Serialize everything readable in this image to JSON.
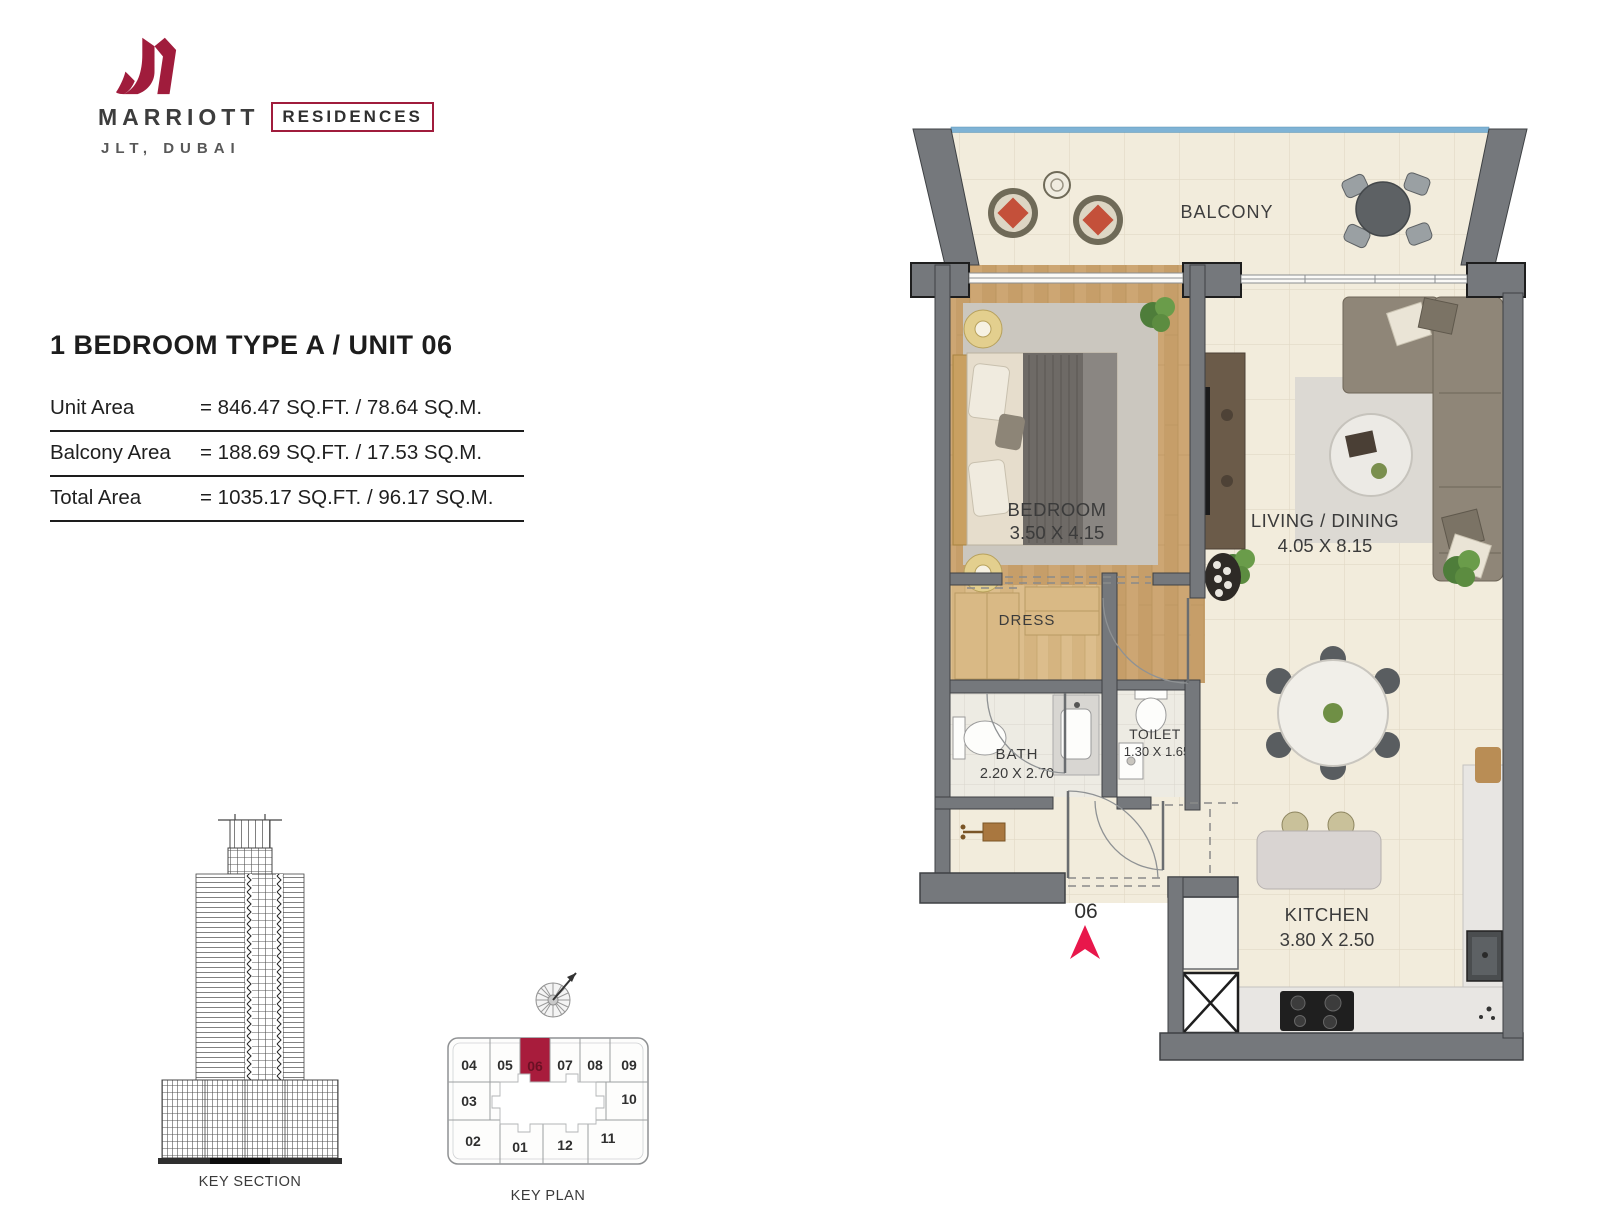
{
  "logo": {
    "brand": "MARRIOTT",
    "boxed": "RESIDENCES",
    "location": "JLT, DUBAI"
  },
  "title": "1 BEDROOM TYPE A  /  UNIT 06",
  "areas": [
    {
      "label": "Unit Area",
      "value": "= 846.47 SQ.FT. / 78.64 SQ.M."
    },
    {
      "label": "Balcony Area",
      "value": "= 188.69 SQ.FT. / 17.53 SQ.M."
    },
    {
      "label": "Total Area",
      "value": "= 1035.17 SQ.FT. / 96.17 SQ.M."
    }
  ],
  "plan": {
    "balcony": "BALCONY",
    "bedroom_name": "BEDROOM",
    "bedroom_dim": "3.50 X 4.15",
    "living_name": "LIVING / DINING",
    "living_dim": "4.05 X 8.15",
    "dress": "DRESS",
    "bath_name": "BATH",
    "bath_dim": "2.20 X 2.70",
    "toilet_name": "TOILET",
    "toilet_dim": "1.30 X 1.65",
    "kitchen_name": "KITCHEN",
    "kitchen_dim": "3.80 X 2.50",
    "entrance_unit": "06"
  },
  "key_section": {
    "caption": "KEY SECTION"
  },
  "key_plan": {
    "caption": "KEY PLAN",
    "highlighted_unit": "06",
    "units": [
      "04",
      "05",
      "06",
      "07",
      "08",
      "09",
      "03",
      "10",
      "02",
      "01",
      "12",
      "11"
    ]
  },
  "colors": {
    "brand_red": "#A01C3C",
    "keyplan_highlight": "#A81C3C",
    "entrance_arrow": "#E8174B",
    "wall_gray": "#75787C",
    "wood_floor": "#CDA673",
    "tile_cream": "#F2ECDC",
    "balcony_glass": "#7FB3D5"
  }
}
